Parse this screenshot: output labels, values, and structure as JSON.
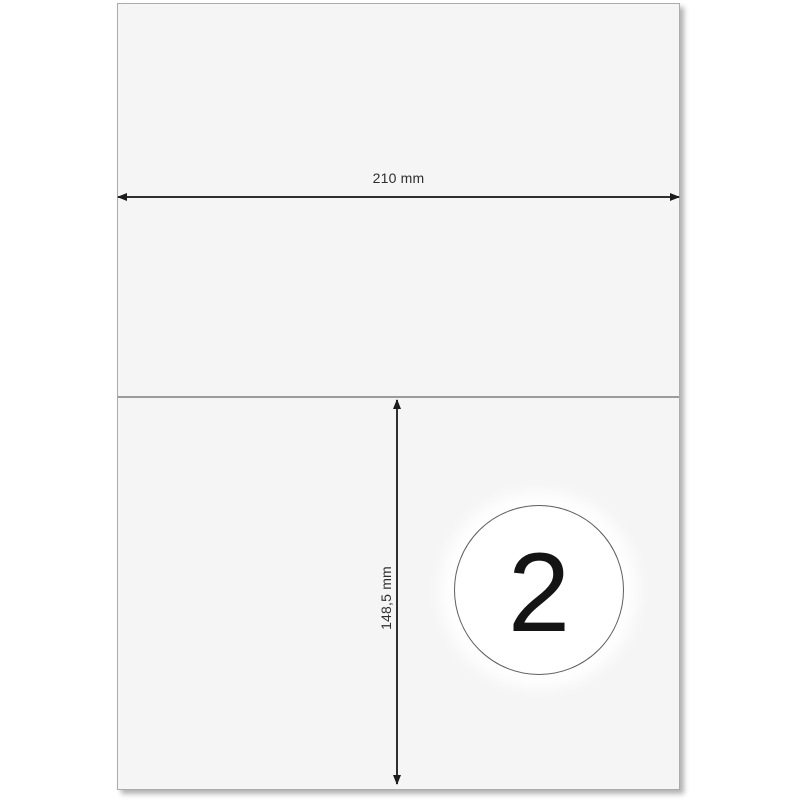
{
  "diagram": {
    "description": "A4 label sheet diagram with 2 labels per sheet",
    "sheet": {
      "width_label": "210 mm",
      "height_label": "148,5 mm",
      "labels_per_sheet": "2"
    },
    "colors": {
      "page_bg": "#ffffff",
      "sheet_bg": "#f5f5f6",
      "sheet_border": "#ababab",
      "divider_line": "#9b9b9b",
      "dimension_line": "#2f2f2f",
      "dimension_text": "#2e2e2e",
      "badge_bg": "#ffffff",
      "badge_border": "#5f5f5f",
      "badge_number": "#141414"
    }
  }
}
